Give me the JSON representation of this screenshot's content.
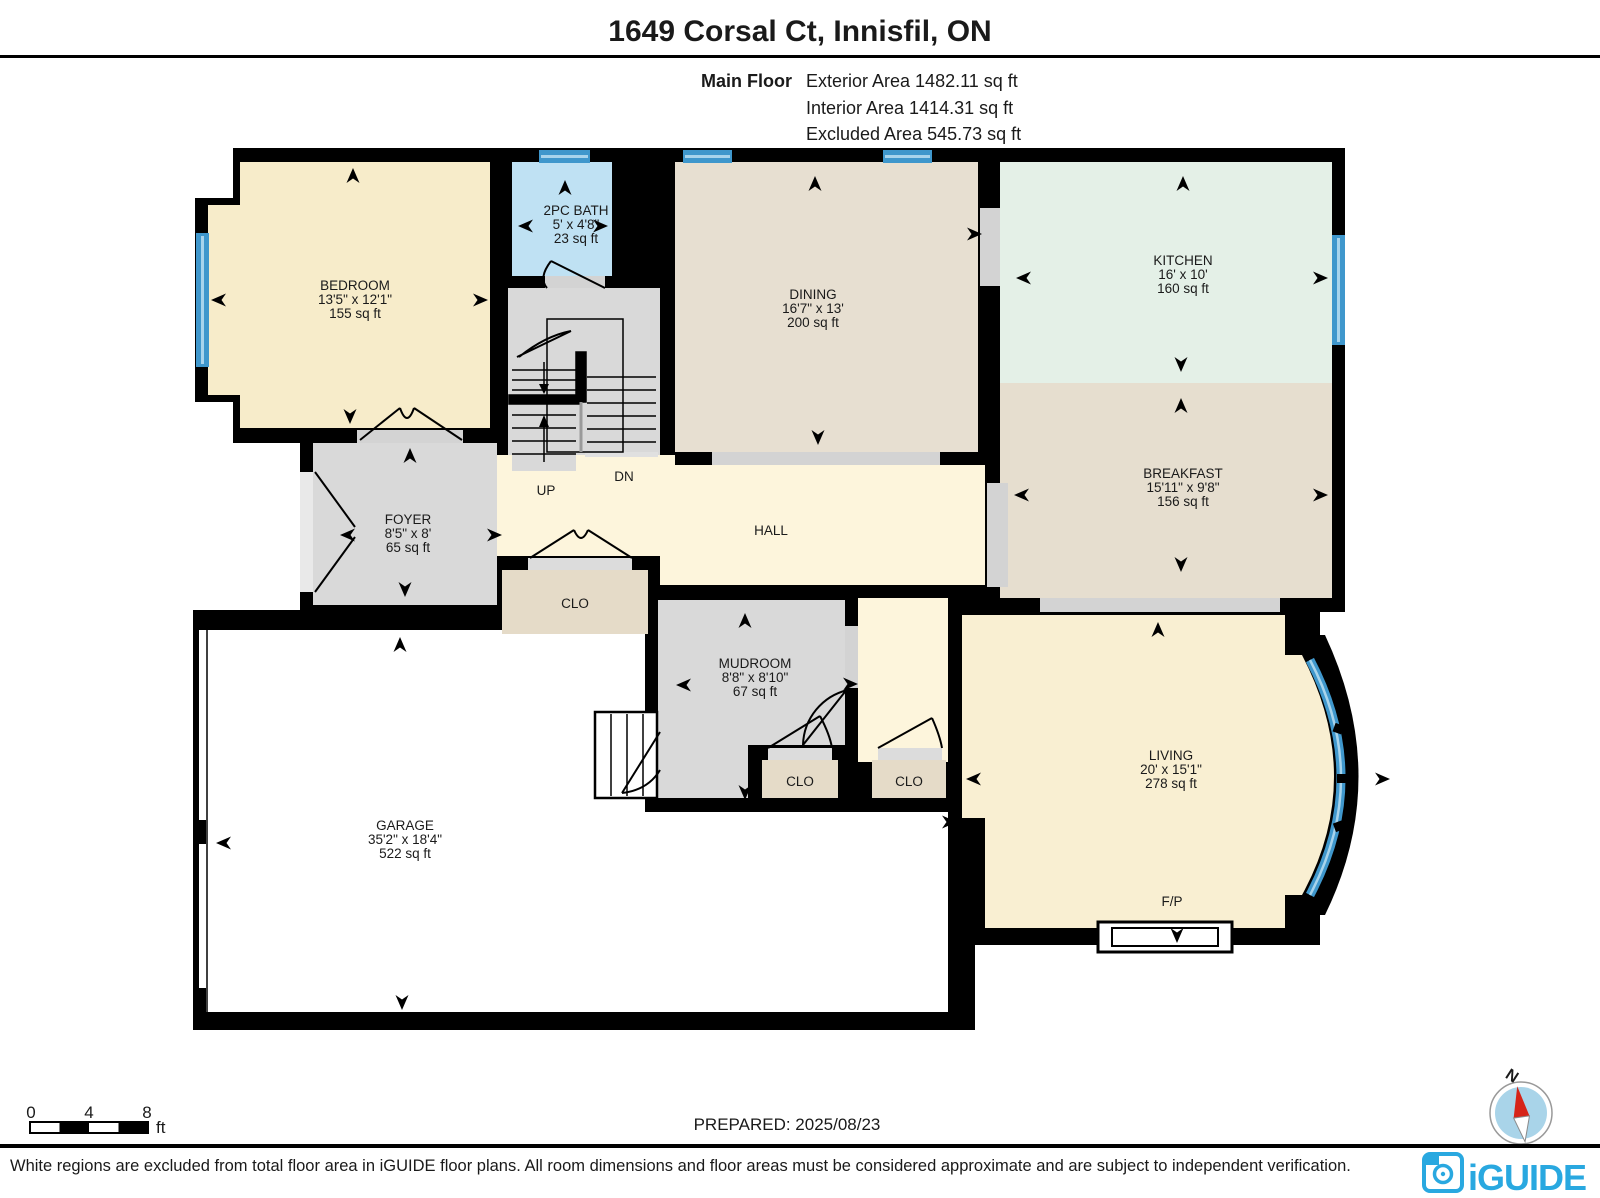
{
  "header": {
    "title": "1649 Corsal Ct, Innisfil, ON",
    "floor_label": "Main Floor",
    "area_lines": [
      "Exterior Area 1482.11 sq ft",
      "Interior Area 1414.31 sq ft",
      "Excluded Area 545.73 sq ft"
    ]
  },
  "rooms": {
    "bedroom": {
      "name": "BEDROOM",
      "dims": "13'5\" x 12'1\"",
      "area": "155 sq ft"
    },
    "bath": {
      "name": "2PC BATH",
      "dims": "5' x 4'8\"",
      "area": "23 sq ft"
    },
    "dining": {
      "name": "DINING",
      "dims": "16'7\" x 13'",
      "area": "200 sq ft"
    },
    "kitchen": {
      "name": "KITCHEN",
      "dims": "16' x 10'",
      "area": "160 sq ft"
    },
    "breakfast": {
      "name": "BREAKFAST",
      "dims": "15'11\" x 9'8\"",
      "area": "156 sq ft"
    },
    "foyer": {
      "name": "FOYER",
      "dims": "8'5\" x 8'",
      "area": "65 sq ft"
    },
    "hall": {
      "name": "HALL"
    },
    "closet_hall": {
      "name": "CLO"
    },
    "mudroom": {
      "name": "MUDROOM",
      "dims": "8'8\" x 8'10\"",
      "area": "67 sq ft"
    },
    "closet_mudroom": {
      "name": "CLO"
    },
    "closet_living": {
      "name": "CLO"
    },
    "living": {
      "name": "LIVING",
      "dims": "20' x 15'1\"",
      "area": "278 sq ft"
    },
    "garage": {
      "name": "GARAGE",
      "dims": "35'2\" x 18'4\"",
      "area": "522 sq ft"
    },
    "fireplace": {
      "name": "F/P"
    },
    "stairs": {
      "up": "UP",
      "down": "DN"
    }
  },
  "scale_bar": {
    "tick_start": "0",
    "tick_mid": "4",
    "tick_end": "8",
    "unit": "ft"
  },
  "compass": {
    "north": "N"
  },
  "footer": {
    "prepared": "PREPARED: 2025/08/23",
    "disclaimer": "White regions are excluded from total floor area in iGUIDE floor plans. All room dimensions and floor areas must be considered approximate and are subject to independent verification.",
    "brand": "iGUIDE"
  },
  "colors": {
    "wall": "#000000",
    "bedroom": "#f7ecca",
    "living": "#f9efd2",
    "hall": "#fdf5dc",
    "dining": "#e7dfd1",
    "breakfast": "#e6decf",
    "closet": "#e5dbc8",
    "kitchen": "#e4f0e7",
    "bath": "#bfe1f3",
    "gray_room": "#d9d9d9",
    "threshold": "#d3d3d3",
    "window": "#3f97cc",
    "window_stripe": "#a8d4ec",
    "brand_blue": "#29a8e0",
    "compass_red": "#d62418",
    "compass_fill": "#a9d4e9"
  }
}
